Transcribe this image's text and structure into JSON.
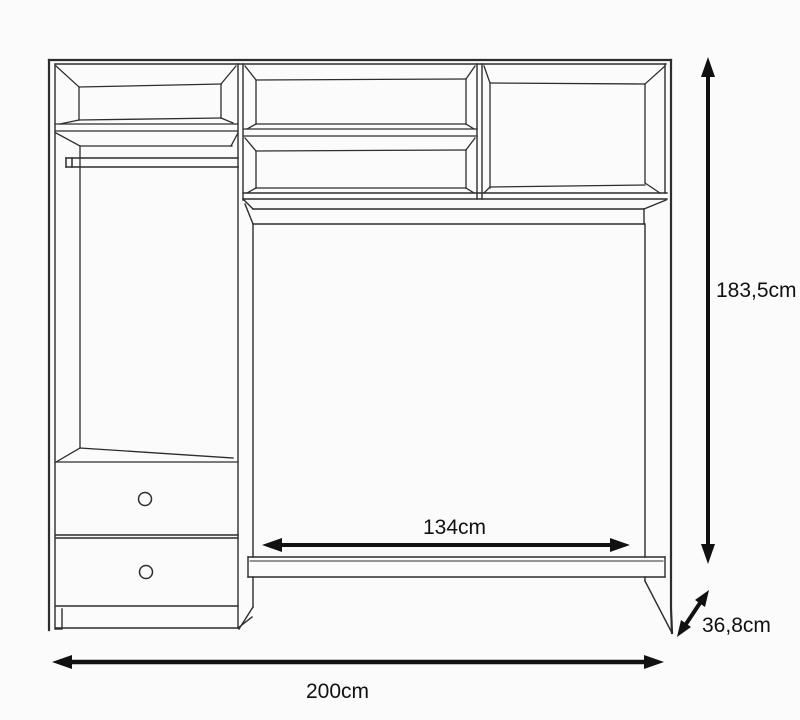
{
  "diagram": {
    "kind": "furniture-technical-drawing",
    "dimensions": {
      "height_label": "183,5cm",
      "inner_width_label": "134cm",
      "total_width_label": "200cm",
      "depth_label": "36,8cm"
    },
    "colors": {
      "background": "#fbfbfb",
      "outline": "#2d2d2d",
      "dimension_arrow": "#111111",
      "label_text": "#111111"
    }
  }
}
